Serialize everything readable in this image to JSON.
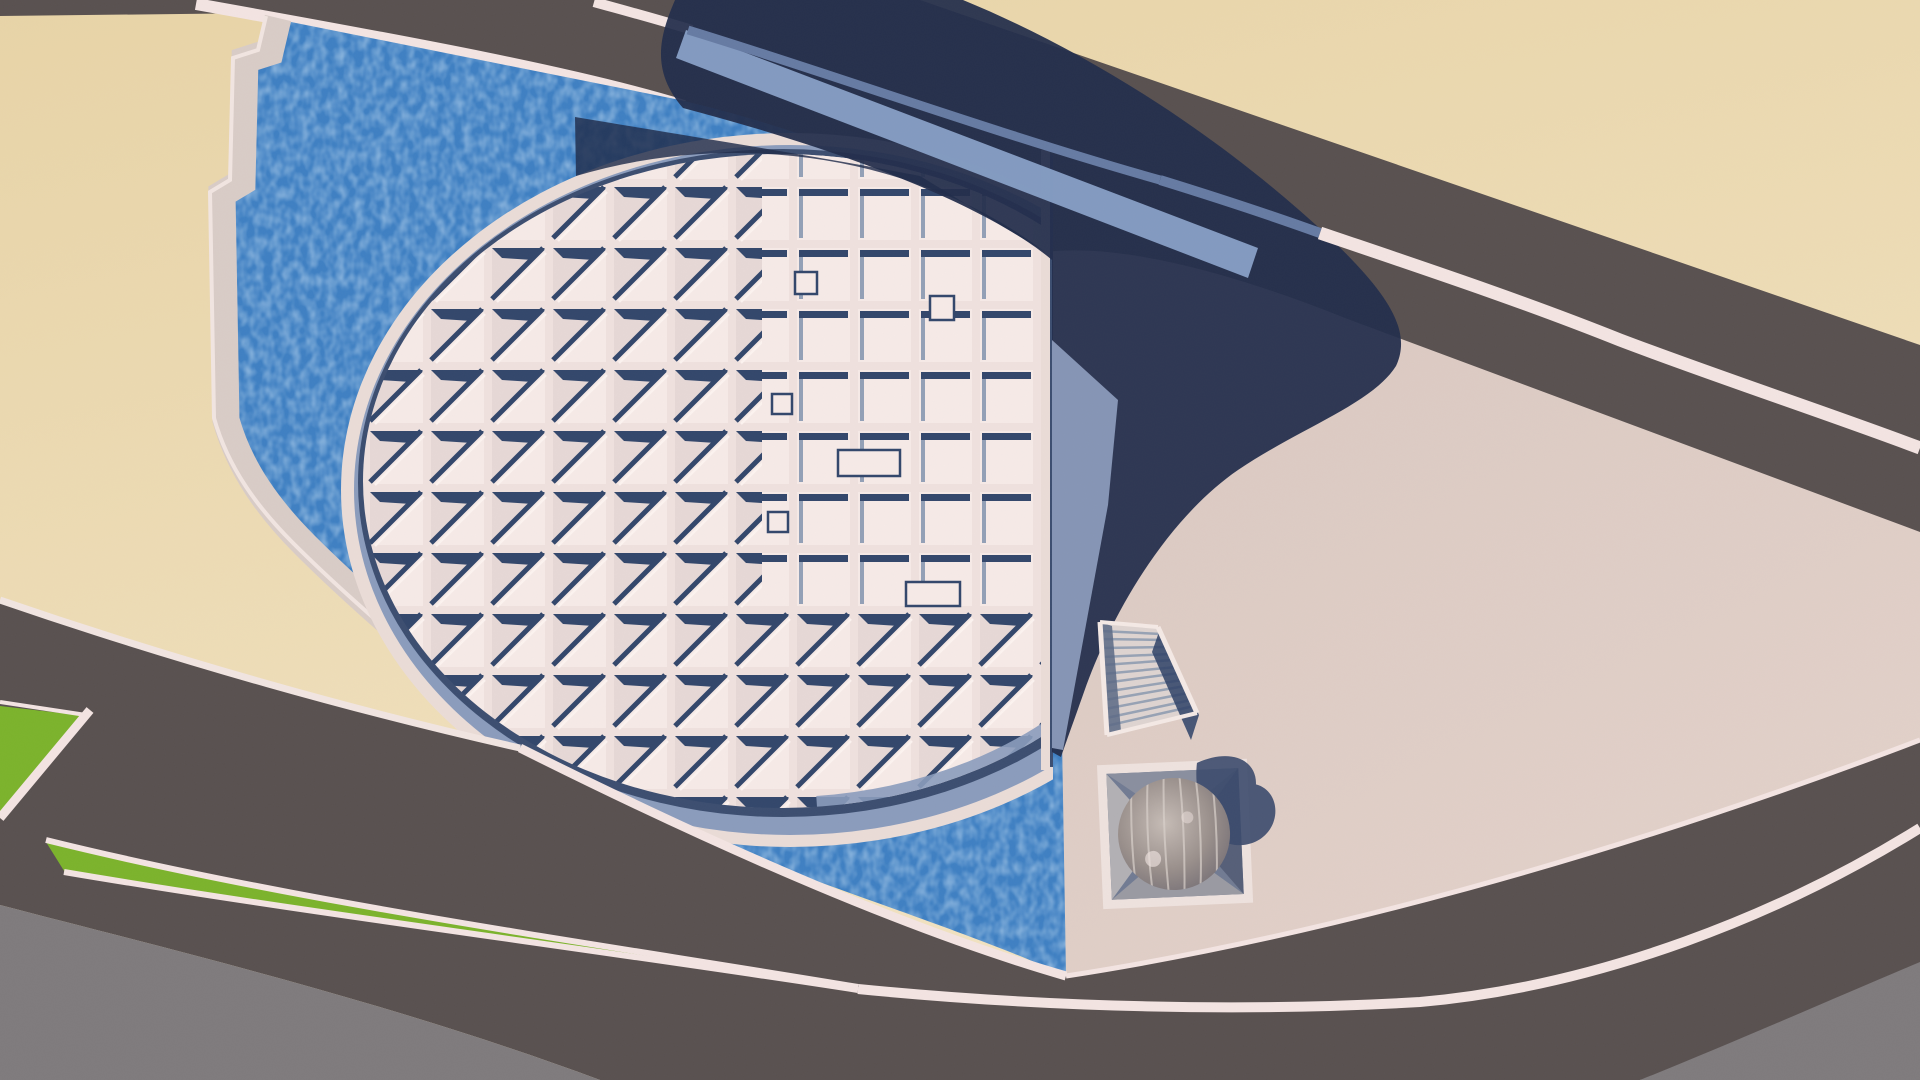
{
  "meta": {
    "title": "Aerial 3D rendering of a tilted-disc library building with coffered roof grid, water basin, plaza, sunken planetarium sphere, stair and curving roads",
    "width": 1920,
    "height": 1080
  },
  "colors": {
    "sand": "#e8d4a7",
    "sand_light": "#f2e3c2",
    "road": "#595150",
    "road_stripe": "#f3e4e2",
    "dim_stripe": "#667ba3",
    "plaza": "#dac8c1",
    "plaza_light": "#e2d1c9",
    "gray_area": "#7f7b7d",
    "grass": "#7cb32c",
    "water": "#3f80c3",
    "water_speckle_r": "0.62",
    "water_speckle_g": "0.78",
    "water_speckle_b": "0.93",
    "shadow_navy": "#232e4b",
    "shadow_water": "#202c4b",
    "shadow_band": "#8695b5",
    "rim_band_lit": "#88a0c6",
    "wall": "#d9ccc7",
    "wall_edge": "#f1e5e1",
    "ring_white": "#eadcd7",
    "ring_gray": "#8b9cbc",
    "ring_dark": "#3c4e70",
    "mullion": "#efe1de",
    "cell_face": "#f6eae7",
    "cell_face_dark": "#e6d8d6",
    "cell_shadow": "#33476b",
    "cell_highlight": "#fcf3f0",
    "crescent": "#8b9cbc",
    "flat_side": "#93a0b6",
    "stair_base": "#ded4d1",
    "stair_tread": "#97a2b4",
    "stair_rail": "#f4e9e5",
    "stair_shadow": "#5a6885",
    "stair_cast": "#2e4166",
    "pit_frame": "#eee2de",
    "pit_inner": "#717b93",
    "pit_face_light": "#b2b0b4",
    "pit_face_top": "#8a8f9f",
    "pit_face_right": "#565f78",
    "pit_face_bottom": "#9a9aa2",
    "pit_cast": "#3b4a6c",
    "sphere_light": "#c6bcb6",
    "sphere_mid": "#9a908c",
    "sphere_dark": "#6e6870",
    "sphere_rib": "#d8d0cb"
  },
  "scene": {
    "elements": [
      {
        "name": "sand-ground",
        "label": "sand colored ground"
      },
      {
        "name": "upper-road",
        "label": "straight diagonal road with lane stripes"
      },
      {
        "name": "water-basin",
        "label": "blue water pool wrapping the disc building"
      },
      {
        "name": "basin-wall",
        "label": "stepped pale retaining wall between sand and water"
      },
      {
        "name": "library-roof-disc",
        "label": "tilted circular roof with coffered skylight grid"
      },
      {
        "name": "disc-cast-shadow",
        "label": "large navy shadow cast by the tilted disc wall"
      },
      {
        "name": "plaza",
        "label": "pink-beige pedestrian plaza"
      },
      {
        "name": "entry-stair",
        "label": "sunken entry staircase"
      },
      {
        "name": "planetarium-pit",
        "label": "square pit with spherical planetarium"
      },
      {
        "name": "lower-boulevard",
        "label": "curving boulevard with green medians"
      },
      {
        "name": "grass-medians",
        "label": "green landscaped median strips"
      },
      {
        "name": "outer-pavement",
        "label": "plain gray outer pavement at bottom corners"
      }
    ]
  }
}
